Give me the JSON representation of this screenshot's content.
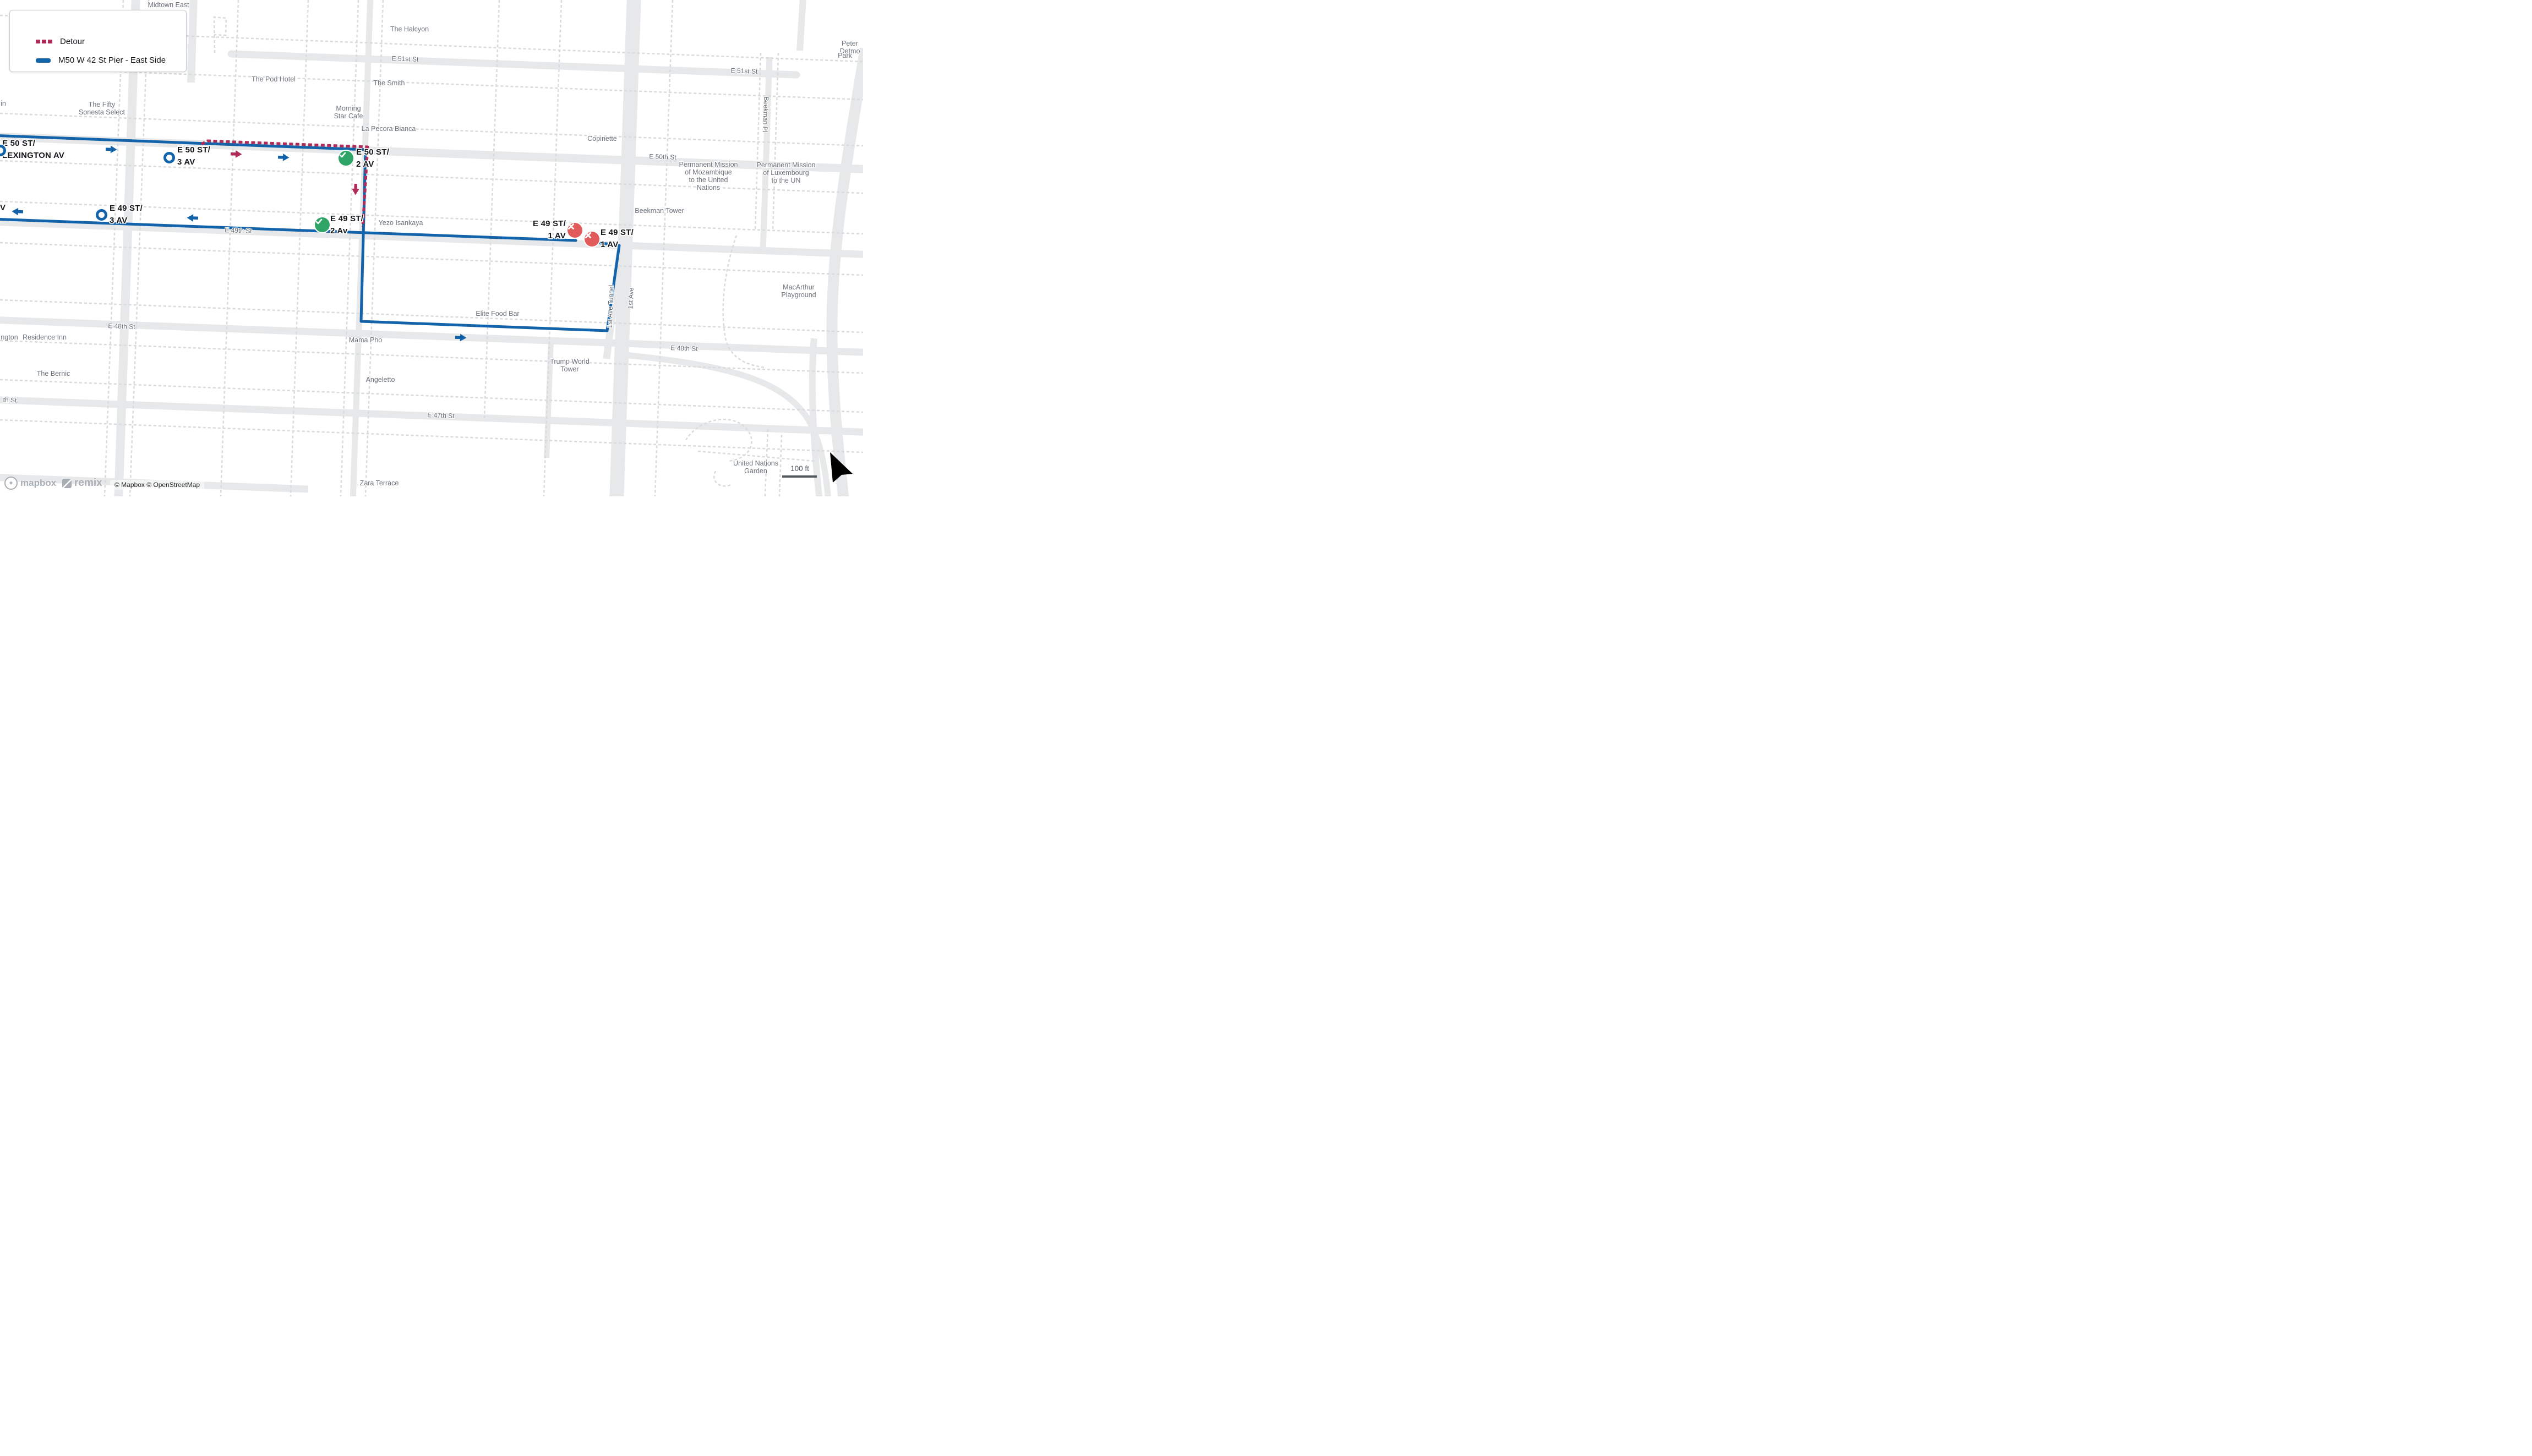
{
  "legend": {
    "items": [
      {
        "label": "Detour",
        "color": "#B12B59",
        "style": "dashed"
      },
      {
        "label": "M50 W 42 St Pier - East Side",
        "color": "#1263A9",
        "style": "solid"
      }
    ]
  },
  "route": {
    "line_color": "#1263A9",
    "detour_color": "#B12B59",
    "stop_open_color": "#2EA567",
    "stop_closed_color": "#E25B5B"
  },
  "stops": [
    {
      "label": "E 50 ST/\nLEXINGTON AV",
      "marker": "ring"
    },
    {
      "label": "E 50 ST/\n3 AV",
      "marker": "ring"
    },
    {
      "label": "E 50 ST/\n2 AV",
      "marker": "check"
    },
    {
      "label": "E 49 ST/\n3 AV",
      "marker": "ring"
    },
    {
      "label": "E 49 ST/\n2 Av",
      "marker": "check"
    },
    {
      "label": "E 49 ST/\n1 AV",
      "marker": "closed"
    },
    {
      "label": "E 49 ST/\n1 AV",
      "marker": "closed"
    },
    {
      "label": "V",
      "marker": "edge-partial"
    }
  ],
  "streets": [
    "E 51st St",
    "E 51st St",
    "E 50th St",
    "E 49th St",
    "E 48th St",
    "E 48th St",
    "E 47th St",
    "th St",
    "Beekman Pl",
    "1st Ave Tunnel",
    "1st Ave"
  ],
  "pois": [
    "Midtown East",
    "The Halcyon",
    "The Pod Hotel",
    "The Smith",
    "The Fifty\nSonesta Select",
    "Morning\nStar Cafe",
    "La Pecora Bianca",
    "Copinette",
    "in",
    "Peter Detmo",
    "Park",
    "Permanent Mission\nof Mozambique\nto the United\nNations",
    "Permanent Mission\nof Luxembourg\nto the UN",
    "Beekman Tower",
    "Yezo Isankaya",
    "MacArthur\nPlayground",
    "Elite Food Bar",
    "Mama Pho",
    "Trump World\nTower",
    "Angeletto",
    "ngton",
    "Residence Inn",
    "The Bernic",
    "United Nations\nGarden",
    "Zara Terrace"
  ],
  "attribution": "© Mapbox © OpenStreetMap",
  "logos": {
    "mapbox": "mapbox",
    "remix": "remix"
  },
  "scale": {
    "label": "100 ft"
  }
}
